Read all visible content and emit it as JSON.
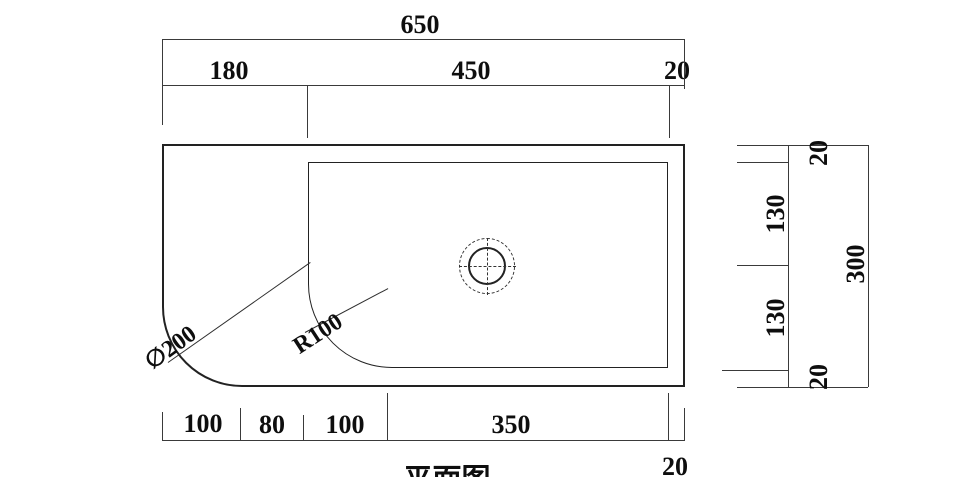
{
  "colors": {
    "line": "#2b2b2b",
    "background": "#ffffff"
  },
  "dimensions": {
    "top": {
      "overall": "650",
      "left": "180",
      "middle": "450",
      "right": "20"
    },
    "bottom": {
      "seg1": "100",
      "seg2": "80",
      "seg3": "100",
      "seg4": "350",
      "edge": "20"
    },
    "side": {
      "top": "20",
      "upper": "130",
      "lower": "130",
      "bottom": "20",
      "overall": "300"
    }
  },
  "callouts": {
    "corner_diameter": "∅200",
    "basin_radius": "R100"
  },
  "title": {
    "text": "平面图"
  }
}
